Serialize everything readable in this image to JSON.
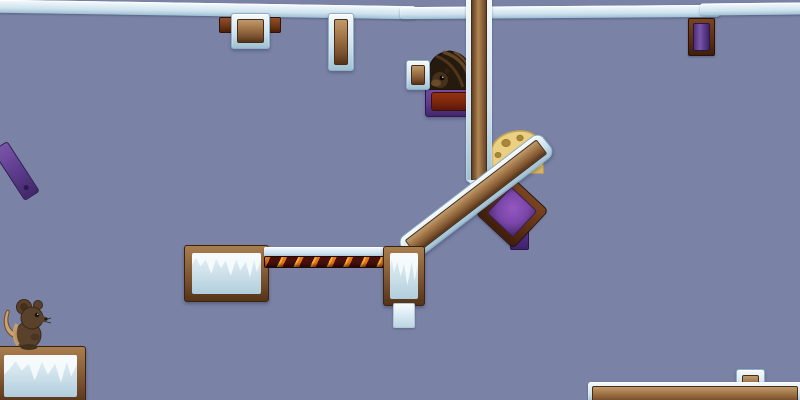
{
  "scene": {
    "description": "2D platformer physics arena (Transformice-style) with ice and wood planks, crates, lava, cheese and a mouse",
    "viewport": {
      "width": 800,
      "height": 400
    }
  },
  "palette": {
    "bg": "#7a82a6",
    "ice-light": "#f4fafd",
    "ice-mid": "#cfe2ee",
    "ice-deep": "#9ec0d4",
    "ice-border": "#8fafc4",
    "wood-light": "#c09a6a",
    "wood-dark": "#543317",
    "purple-frame": "#5a3a8a",
    "purple-fill": "#7a46a8",
    "choco": "#7a240c",
    "lava-dark": "#48100a",
    "lava-orange": "#e8741a",
    "lava-yellow": "#f4b02a",
    "cheese-yellow": "#ead083",
    "cheese-hole": "#ab8638",
    "mouse-brown": "#5a412c"
  },
  "objects": {
    "ceiling_left": {
      "x": -4,
      "y": 3,
      "w": 420,
      "h": 13,
      "rot": 0.9,
      "label": "ice ceiling beam"
    },
    "ceiling_mid": {
      "x": 400,
      "y": 6,
      "w": 320,
      "h": 12,
      "rot": -0.4,
      "label": "ice ceiling beam"
    },
    "ceiling_right": {
      "x": 700,
      "y": 3,
      "w": 105,
      "h": 12,
      "rot": -0.6,
      "label": "ice ceiling beam"
    },
    "crate_top": {
      "x": 231,
      "y": 13,
      "w": 37,
      "h": 34,
      "label": "ice-framed wood crate"
    },
    "crate_top_tab_left": {
      "x": 219,
      "y": 17,
      "w": 14,
      "h": 14,
      "label": "wood tab"
    },
    "crate_top_tab_right": {
      "x": 265,
      "y": 17,
      "w": 14,
      "h": 14,
      "label": "wood tab"
    },
    "crate_top_vertical": {
      "x": 328,
      "y": 13,
      "w": 24,
      "h": 56,
      "label": "ice-framed wood crate"
    },
    "purple_crate_top_right": {
      "x": 688,
      "y": 18,
      "w": 25,
      "h": 36,
      "label": "wood-framed purple crate"
    },
    "purple_plank_left": {
      "x": -14,
      "y": 162,
      "w": 58,
      "h": 16,
      "rot": 57,
      "label": "purple plank"
    },
    "hole_base": {
      "x": 425,
      "y": 86,
      "w": 48,
      "h": 29,
      "label": "purple-framed chocolate block"
    },
    "hole_mound": {
      "x": 427,
      "y": 49,
      "w": 45,
      "h": 41,
      "label": "mouse hole mound with peeking mouse"
    },
    "small_crate": {
      "x": 406,
      "y": 60,
      "w": 22,
      "h": 28,
      "label": "ice-framed wood crate"
    },
    "cheese": {
      "x": 486,
      "y": 128,
      "w": 60,
      "h": 48,
      "label": "cheese wedge"
    },
    "pillar": {
      "x": 466,
      "y": -6,
      "w": 26,
      "h": 188,
      "label": "vertical wood plank"
    },
    "pillar_tip": {
      "x": 467,
      "y": 180,
      "label": "plank tip"
    },
    "pillar_tip_wood": {
      "x": 472,
      "y": 178,
      "label": "plank tip wood"
    },
    "purple_tab": {
      "x": 510,
      "y": 212,
      "w": 17,
      "h": 36,
      "label": "purple peg"
    },
    "purple_crate": {
      "x": 486,
      "y": 186,
      "w": 50,
      "h": 50,
      "rot": 43,
      "label": "rotated wood-framed purple crate"
    },
    "diag_plank": {
      "x": 386,
      "y": 183,
      "w": 178,
      "h": 26,
      "rot": -37.5,
      "label": "diagonal wood plank"
    },
    "ice_block_large": {
      "x": 184,
      "y": 245,
      "w": 83,
      "h": 55,
      "label": "wood-framed ice block"
    },
    "lava_bar": {
      "x": 264,
      "y": 247,
      "w": 121,
      "h": 21,
      "label": "ice beam with lava underside"
    },
    "ice_block_small": {
      "x": 383,
      "y": 246,
      "w": 40,
      "h": 58,
      "label": "wood-framed ice block"
    },
    "ice_stub": {
      "x": 393,
      "y": 303,
      "w": 20,
      "h": 23,
      "label": "small ice block"
    },
    "ice_block_bottom_left": {
      "x": -5,
      "y": 346,
      "w": 89,
      "h": 58,
      "label": "wood-framed ice block"
    },
    "mouse": {
      "x": 1,
      "y": 297,
      "w": 50,
      "h": 53,
      "label": "brown mouse player character"
    },
    "plank_bottom_right": {
      "x": 588,
      "y": 382,
      "w": 214,
      "h": 20,
      "label": "horizontal wood plank"
    },
    "crate_bottom_right": {
      "x": 736,
      "y": 369,
      "w": 27,
      "h": 29,
      "label": "ice-framed wood crate"
    }
  }
}
